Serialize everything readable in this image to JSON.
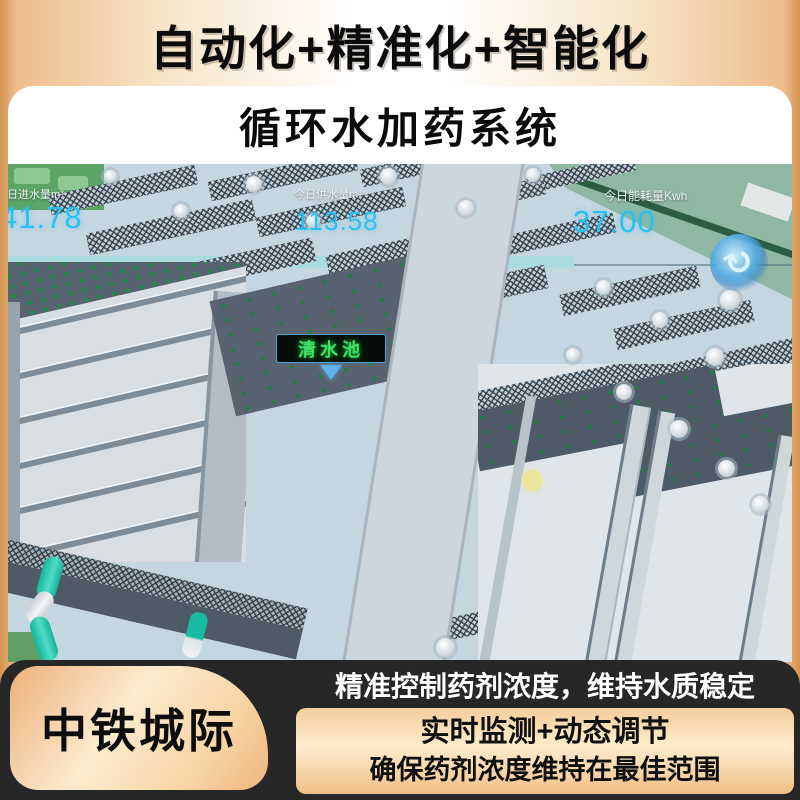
{
  "header": {
    "title": "自动化+精准化+智能化",
    "subtitle": "循环水加药系统"
  },
  "scene": {
    "metrics": [
      {
        "label": "今日进水量m³",
        "value": "41.78"
      },
      {
        "label": "今日供水量m³",
        "value": "113.58"
      },
      {
        "label": "今日能耗量Kwh",
        "value": "37.00"
      }
    ],
    "pool_label": "清水池",
    "compass_glyph": "↻"
  },
  "footer": {
    "brand": "中铁城际",
    "headline": "精准控制药剂浓度，维持水质稳定",
    "lines": [
      "实时监测+动态调节",
      "确保药剂浓度维持在最佳范围"
    ]
  },
  "colors": {
    "metric_value_cyan": "#2ac1f2",
    "pool_label_green": "#3fe267",
    "frame_orange": "#e2a269",
    "footer_band_dark": "#272727",
    "pipe_teal": "#16bba1",
    "grass_green": "#8fb7a4",
    "platform_blue_gray": "#c4d6df"
  }
}
